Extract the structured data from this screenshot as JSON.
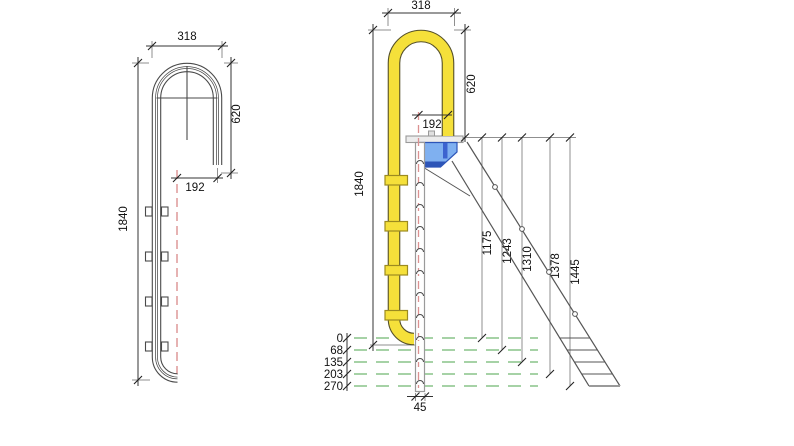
{
  "title": "pool-ladder technical drawing, side profile and front elevation with dimensions (mm)",
  "left_view": {
    "dim_width_top": "318",
    "dim_hook_height": "620",
    "dim_offset": "192",
    "dim_total_height": "1840"
  },
  "right_view": {
    "dim_width_top": "318",
    "dim_hook_height": "620",
    "dim_offset": "192",
    "dim_total_height": "1840",
    "dim_rail_width": "45",
    "leg_lengths": [
      "1175",
      "1243",
      "1310",
      "1378",
      "1445"
    ],
    "floor_levels": [
      "0",
      "68",
      "135",
      "203",
      "270"
    ]
  },
  "colors": {
    "handrail_yellow": "#f5e03a",
    "handrail_outline": "#55502a",
    "step_blue": "#7fb0f0",
    "step_blue_dark": "#2d55b8",
    "water_level_green": "#71b871",
    "centerline_red": "#db9191",
    "drawing_line": "#4a4a4a",
    "reference_grey": "#9a9a9a"
  }
}
